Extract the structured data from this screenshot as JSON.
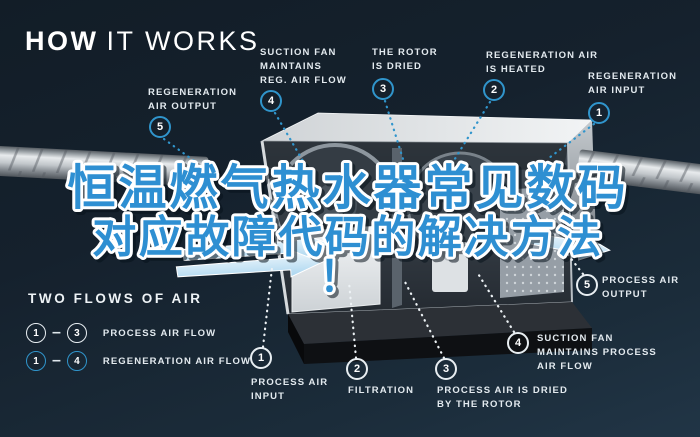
{
  "title": {
    "bold": "HOW",
    "light": "IT WORKS"
  },
  "headline": {
    "line1": "恒温燃气热水器常见数码",
    "line2": "对应故障代码的解决方法",
    "line3": "！"
  },
  "top_labels": [
    {
      "num": "5",
      "text": "REGENERATION\nAIR OUTPUT"
    },
    {
      "num": "4",
      "text": "SUCTION FAN\nMAINTAINS\nREG. AIR FLOW"
    },
    {
      "num": "3",
      "text": "THE ROTOR\nIS DRIED"
    },
    {
      "num": "2",
      "text": "REGENERATION AIR\nIS HEATED"
    },
    {
      "num": "1",
      "text": "REGENERATION\nAIR INPUT"
    }
  ],
  "bottom_labels": [
    {
      "num": "1",
      "text": "PROCESS AIR\nINPUT"
    },
    {
      "num": "2",
      "text": "FILTRATION"
    },
    {
      "num": "3",
      "text": "PROCESS AIR IS DRIED\nBY THE ROTOR"
    },
    {
      "num": "4",
      "text": "SUCTION FAN\nMAINTAINS PROCESS\nAIR FLOW"
    },
    {
      "num": "5",
      "text": "PROCESS AIR\nOUTPUT"
    }
  ],
  "legend": {
    "title": "TWO FLOWS OF AIR",
    "rows": [
      {
        "from": "1",
        "dash": "–",
        "to": "3",
        "label": "PROCESS AIR FLOW"
      },
      {
        "from": "1",
        "dash": "–",
        "to": "4",
        "label": "REGENERATION AIR FLOW"
      }
    ]
  },
  "colors": {
    "background": "#16222e",
    "accent_blue": "#3095cc",
    "headline_blue": "#2e8fd2",
    "label_text": "#e3eaef",
    "white_circle": "#e8eef2"
  }
}
